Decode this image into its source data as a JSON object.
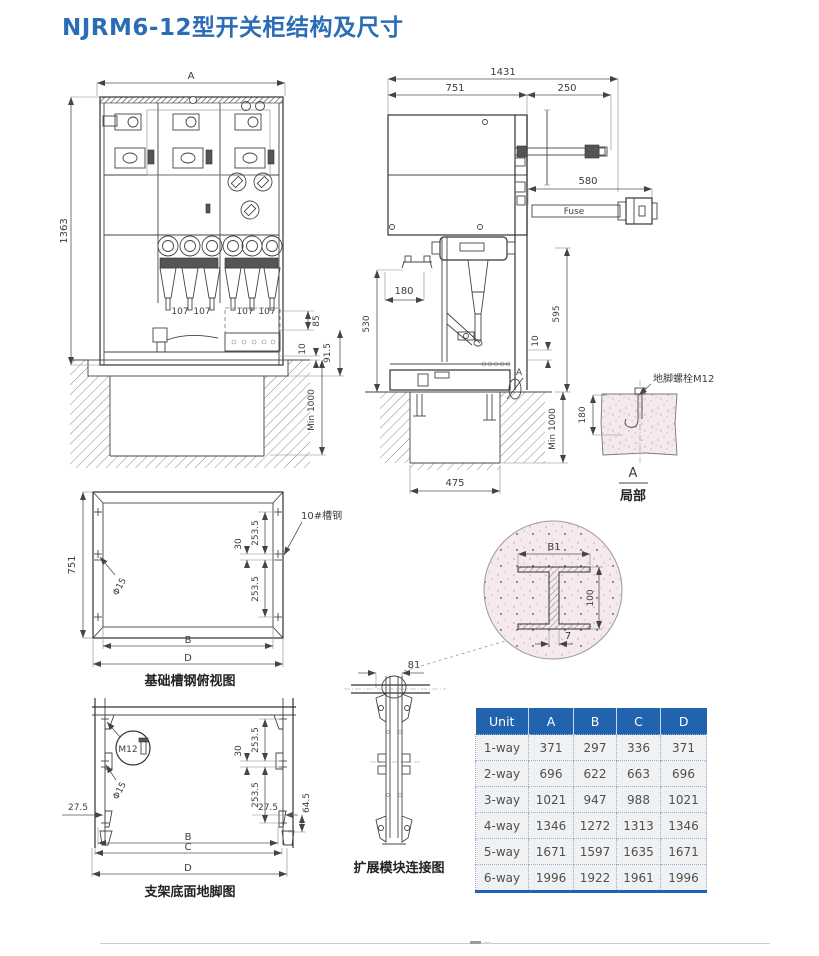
{
  "page": {
    "title": "NJRM6-12型开关柜结构及尺寸"
  },
  "front_view": {
    "dim_width": "A",
    "dim_height": "1363",
    "cone_labels": [
      "107",
      "107",
      "107",
      "107"
    ],
    "dim_85": "85",
    "dim_10": "10",
    "dim_91_5": "91.5",
    "dim_min_1000": "Min 1000"
  },
  "side_view": {
    "dim_1431": "1431",
    "dim_751": "751",
    "dim_250": "250",
    "dim_580": "580",
    "fuse_label": "Fuse",
    "dim_180": "180",
    "dim_530": "530",
    "dim_595": "595",
    "dim_10": "10",
    "dim_min_1000": "Min 1000",
    "dim_475": "475",
    "section_marker": "A"
  },
  "detail_a": {
    "bolt_label": "地脚螺栓M12",
    "dim_180": "180",
    "marker": "A",
    "caption": "局部"
  },
  "foundation_plan": {
    "caption": "基础槽钢俯视图",
    "channel_label": "10#槽钢",
    "hole_label": "Φ15",
    "dim_751": "751",
    "dim_30": "30",
    "dim_253_5_a": "253.5",
    "dim_253_5_b": "253.5",
    "dim_B": "B",
    "dim_D": "D"
  },
  "bracket_plan": {
    "caption": "支架底面地脚图",
    "bolt_label": "M12",
    "hole_label": "Φ15",
    "dim_27_5_left": "27.5",
    "dim_27_5_right": "27.5",
    "dim_64_5": "64.5",
    "dim_30": "30",
    "dim_253_5_a": "253.5",
    "dim_253_5_b": "253.5",
    "dim_B": "B",
    "dim_C": "C",
    "dim_D": "D"
  },
  "module_diagram": {
    "caption": "扩展模块连接图",
    "dim_81": "81"
  },
  "beam_detail": {
    "dim_B1": "B1",
    "dim_100": "100",
    "dim_7": "7"
  },
  "spec_table": {
    "headers": [
      "Unit",
      "A",
      "B",
      "C",
      "D"
    ],
    "rows": [
      {
        "unit": "1-way",
        "A": "371",
        "B": "297",
        "C": "336",
        "D": "371"
      },
      {
        "unit": "2-way",
        "A": "696",
        "B": "622",
        "C": "663",
        "D": "696"
      },
      {
        "unit": "3-way",
        "A": "1021",
        "B": "947",
        "C": "988",
        "D": "1021"
      },
      {
        "unit": "4-way",
        "A": "1346",
        "B": "1272",
        "C": "1313",
        "D": "1346"
      },
      {
        "unit": "5-way",
        "A": "1671",
        "B": "1597",
        "C": "1635",
        "D": "1671"
      },
      {
        "unit": "6-way",
        "A": "1996",
        "B": "1922",
        "C": "1961",
        "D": "1996"
      }
    ]
  },
  "colors": {
    "title_blue": "#2b6cb6",
    "table_header_blue": "#2163ae",
    "concrete_pink": "#f6e9ec",
    "line_dark": "#444444"
  }
}
